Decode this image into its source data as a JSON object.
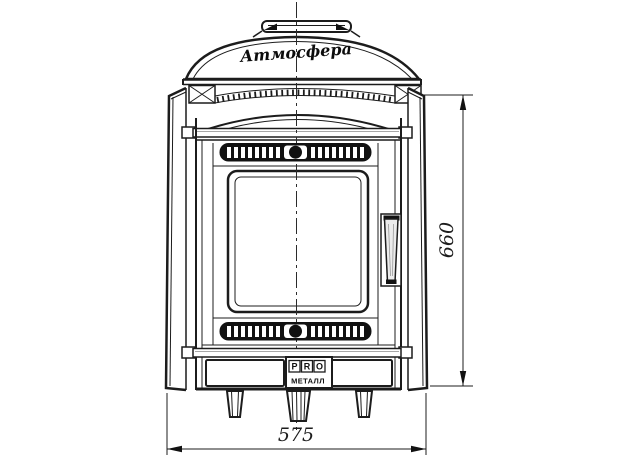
{
  "drawing": {
    "dimensions": {
      "width_mm": "575",
      "height_mm": "660"
    },
    "branding": {
      "dome_script": "Атмосфера",
      "badge_letters": [
        "P",
        "R",
        "O"
      ],
      "badge_text": "МЕТАЛЛ"
    },
    "colors": {
      "line": "#1c1c1c",
      "background": "#ffffff"
    }
  }
}
